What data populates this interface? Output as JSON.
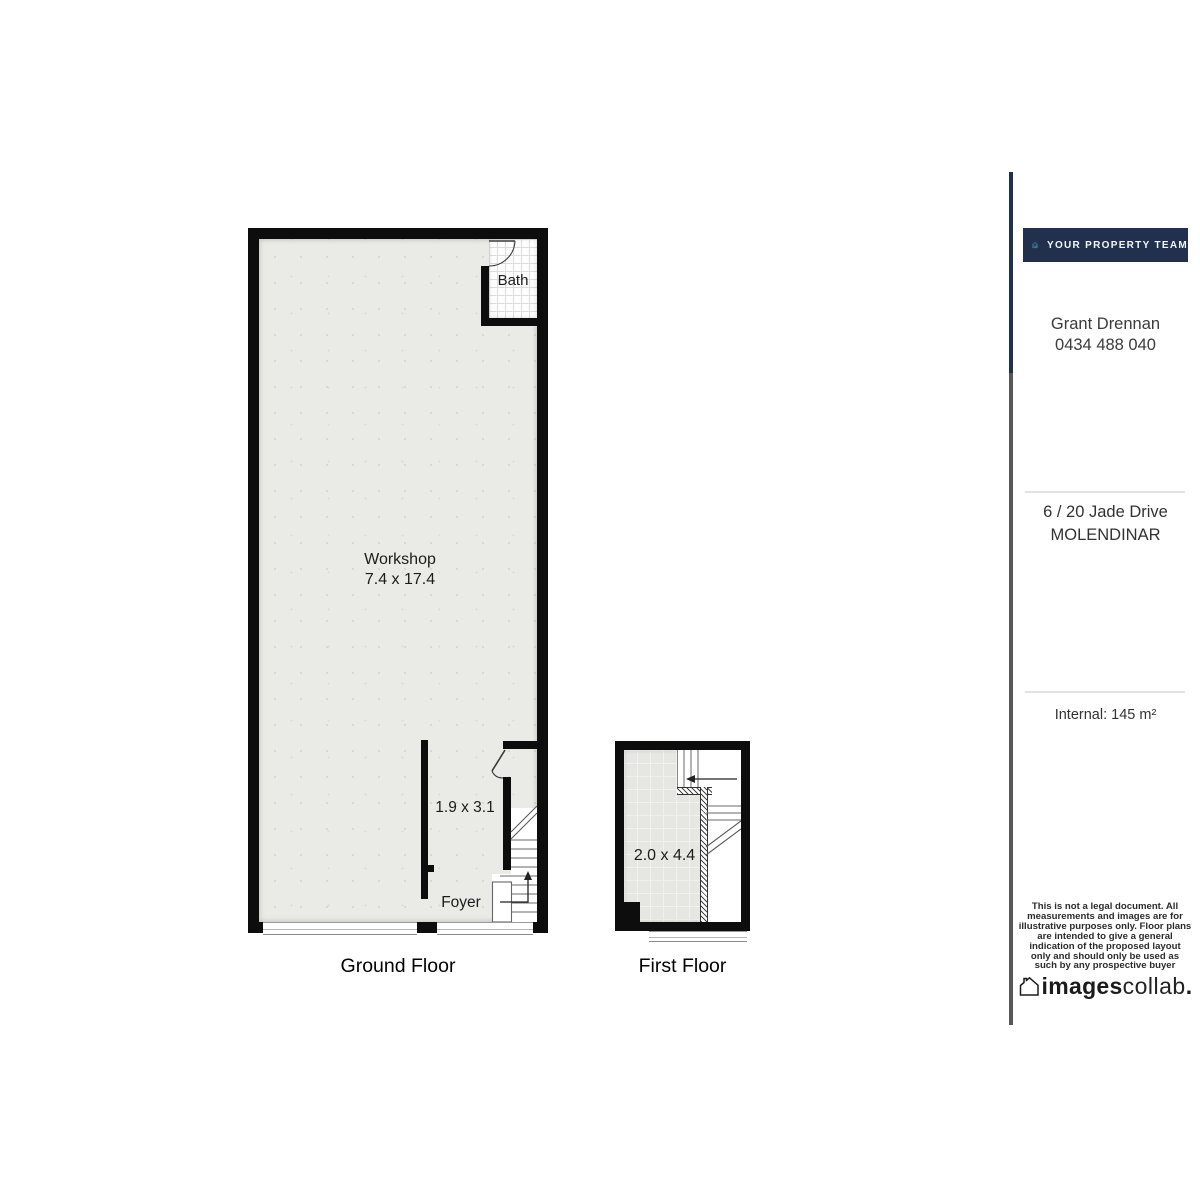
{
  "plans": {
    "ground_floor": {
      "label": "Ground Floor",
      "workshop": {
        "name": "Workshop",
        "dims": "7.4 x 17.4"
      },
      "bath": {
        "name": "Bath"
      },
      "foyer": {
        "name": "Foyer",
        "dims": "1.9 x 3.1"
      }
    },
    "first_floor": {
      "label": "First Floor",
      "room": {
        "dims": "2.0 x 4.4"
      }
    }
  },
  "sidebar": {
    "brand": "YOUR PROPERTY TEAM",
    "agent_name": "Grant Drennan",
    "agent_phone": "0434 488 040",
    "address_line1": "6 / 20 Jade Drive",
    "address_line2": "MOLENDINAR",
    "internal_area": "Internal: 145 m²",
    "disclaimer": "This is not a legal document. All\nmeasurements and images are for\nillustrative purposes only. Floor plans\nare intended to give a general\nindication of the proposed layout\nonly and should only be used as\nsuch by any prospective buyer",
    "watermark_bold": "images",
    "watermark_light": "collab",
    "watermark_period": "."
  },
  "colors": {
    "wall": "#0d0d0d",
    "floor_fill": "#eaeae6",
    "navy": "#21304d",
    "brand_blue": "#4aa8d8",
    "line_gray": "#57575a",
    "divider": "#e3e3e3"
  }
}
